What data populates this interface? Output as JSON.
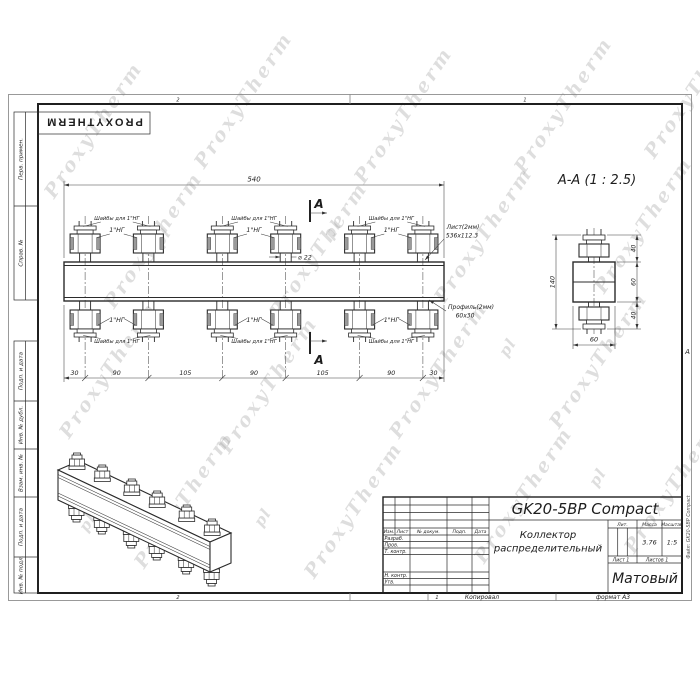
{
  "watermark": {
    "brand": "ProxyTherm",
    "short": "pl"
  },
  "header_stamp": {
    "brand": "PROXYTHERM"
  },
  "frame": {
    "zone_top_left": "2",
    "zone_top_right": "1",
    "zone_bottom_left": "2",
    "zone_bottom_right": "1",
    "copied_label": "Копировал",
    "format_label": "формат А3",
    "fold_letter": "А"
  },
  "sidebar": {
    "labels": [
      "Перв. примен.",
      "Справ. №",
      "Подп. и дата",
      "Инв. № дубл.",
      "Взам. инв. №",
      "Подп. и дата",
      "Инв. № подл."
    ]
  },
  "front_view": {
    "dim_total": "540",
    "dim_chain": [
      "30",
      "90",
      "105",
      "90",
      "105",
      "90",
      "30"
    ],
    "washers_label": "Шайбы для 1\"НГ",
    "thread_label": "1\"НГ",
    "diameter_label": "⌀ 22",
    "section_letter": "A",
    "sheet_callout_line1": "Лист(2мм)",
    "sheet_callout_line2": "536х112.3",
    "profile_callout_line1": "Профиль(2мм)",
    "profile_callout_line2": "60х30"
  },
  "section_view": {
    "title": "A-A  (1 : 2.5)",
    "dim_height": "140",
    "dim_top": "40",
    "dim_middle": "60",
    "dim_bottom": "40",
    "dim_width": "60"
  },
  "title_block": {
    "doc_code": "GK20-5BP Compact",
    "doc_name_line1": "Коллектор",
    "doc_name_line2": "распределительный",
    "finish": "Матовый",
    "col_izm": "Изм.",
    "col_list": "Лист",
    "col_doc": "№ докум.",
    "col_sign": "Подп.",
    "col_date": "Дата",
    "row_developed": "Разраб.",
    "row_checked": "Пров.",
    "row_tcontrol": "Т. контр.",
    "row_ncontrol": "Н. контр.",
    "row_approved": "Утв.",
    "lit_label": "Лит.",
    "mass_label": "Масса",
    "scale_label": "Масштаб",
    "mass_value": "3.76",
    "scale_value": "1:5",
    "sheet_label": "Лист 1",
    "sheets_label": "Листов 1",
    "file_label": "Файл: GK20-5BP Compact"
  }
}
